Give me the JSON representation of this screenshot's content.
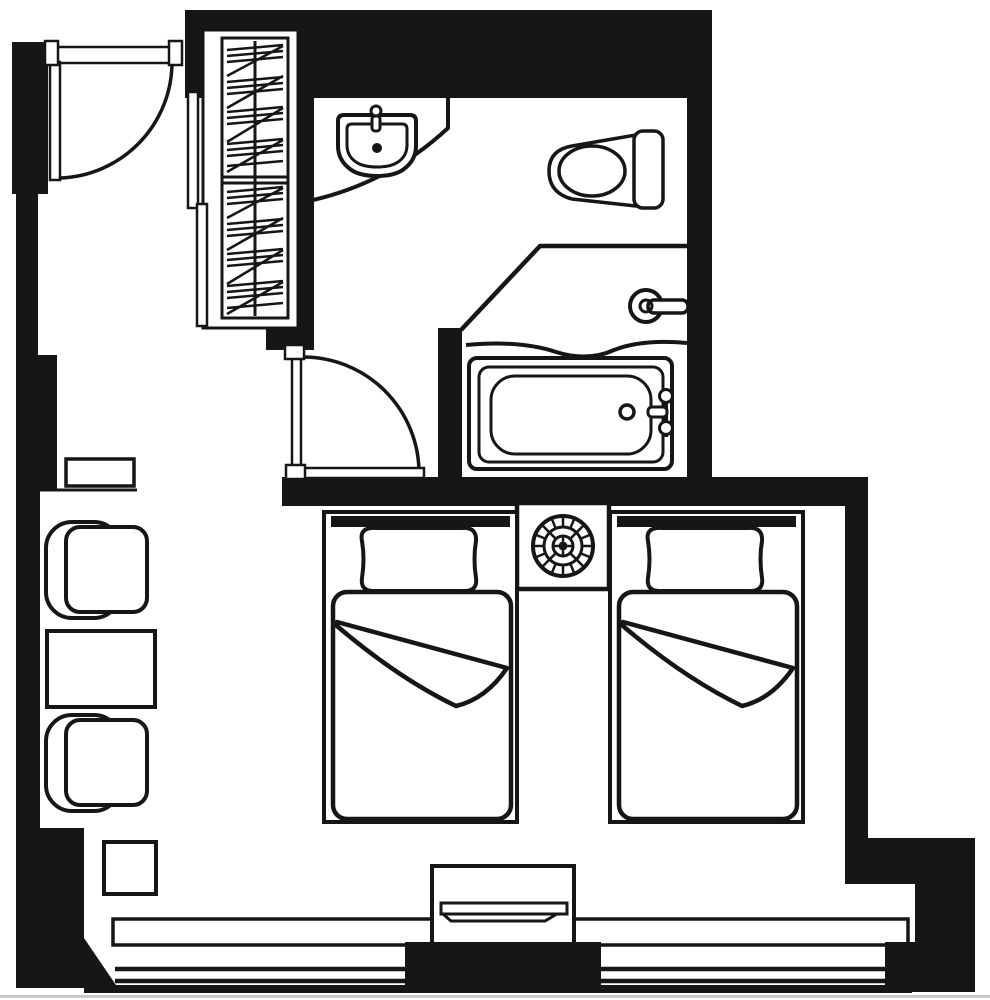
{
  "colors": {
    "background": "#ffffff",
    "ink": "#161616",
    "photo_edge": "#c9c9c9"
  },
  "floorplan": {
    "kind": "hotel-guestroom-plan",
    "rooms": [
      "entry",
      "closet",
      "bathroom",
      "bedroom",
      "sitting-area"
    ],
    "elements": [
      "entry-door",
      "closet-hanger-rack",
      "closet-sliding-panels",
      "vanity-counter",
      "sink",
      "toilet",
      "shower-partition",
      "shower-curtain",
      "shower-valve",
      "bathtub",
      "tub-faucet",
      "bathroom-door",
      "nightstand-sunburst",
      "twin-bed-left",
      "twin-bed-right",
      "wall-shelf",
      "lounge-chair-upper",
      "coffee-table",
      "lounge-chair-lower",
      "side-table-square",
      "tv-cabinet",
      "television",
      "window-wall"
    ]
  }
}
